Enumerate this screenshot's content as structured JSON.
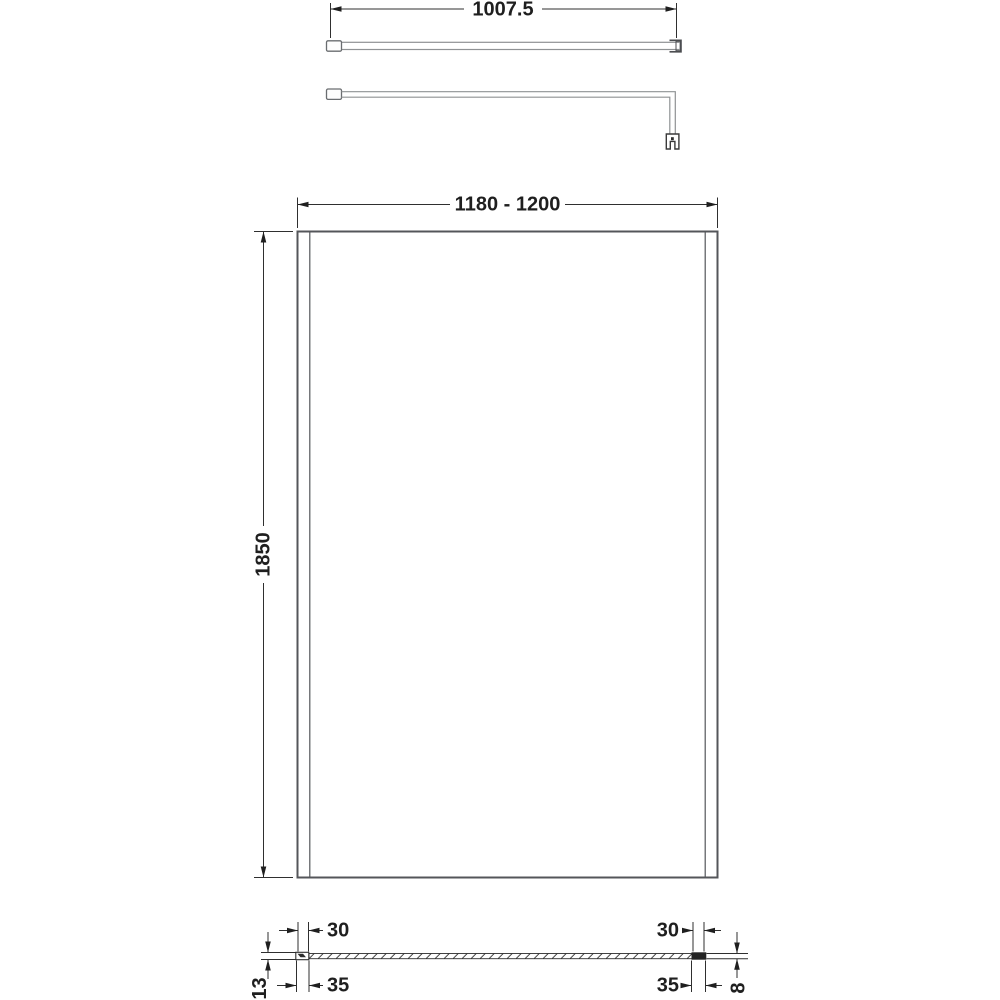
{
  "diagram": {
    "type": "technical-drawing",
    "views": {
      "support_arm_plan": {
        "dimension_length": "1007.5"
      },
      "support_arm_side": {},
      "panel_front": {
        "dimension_width": "1180 - 1200",
        "dimension_height": "1850"
      },
      "panel_section": {
        "left_glass_inset": "30",
        "left_profile_width": "35",
        "left_profile_depth": "13",
        "right_glass_inset": "30",
        "right_profile_width": "35",
        "glass_thickness": "8"
      }
    },
    "colors": {
      "line": "#54565a",
      "line_light": "#8f9294",
      "dimension_line": "#2f2f2f",
      "text": "#1f1f1f",
      "background": "#ffffff"
    }
  }
}
